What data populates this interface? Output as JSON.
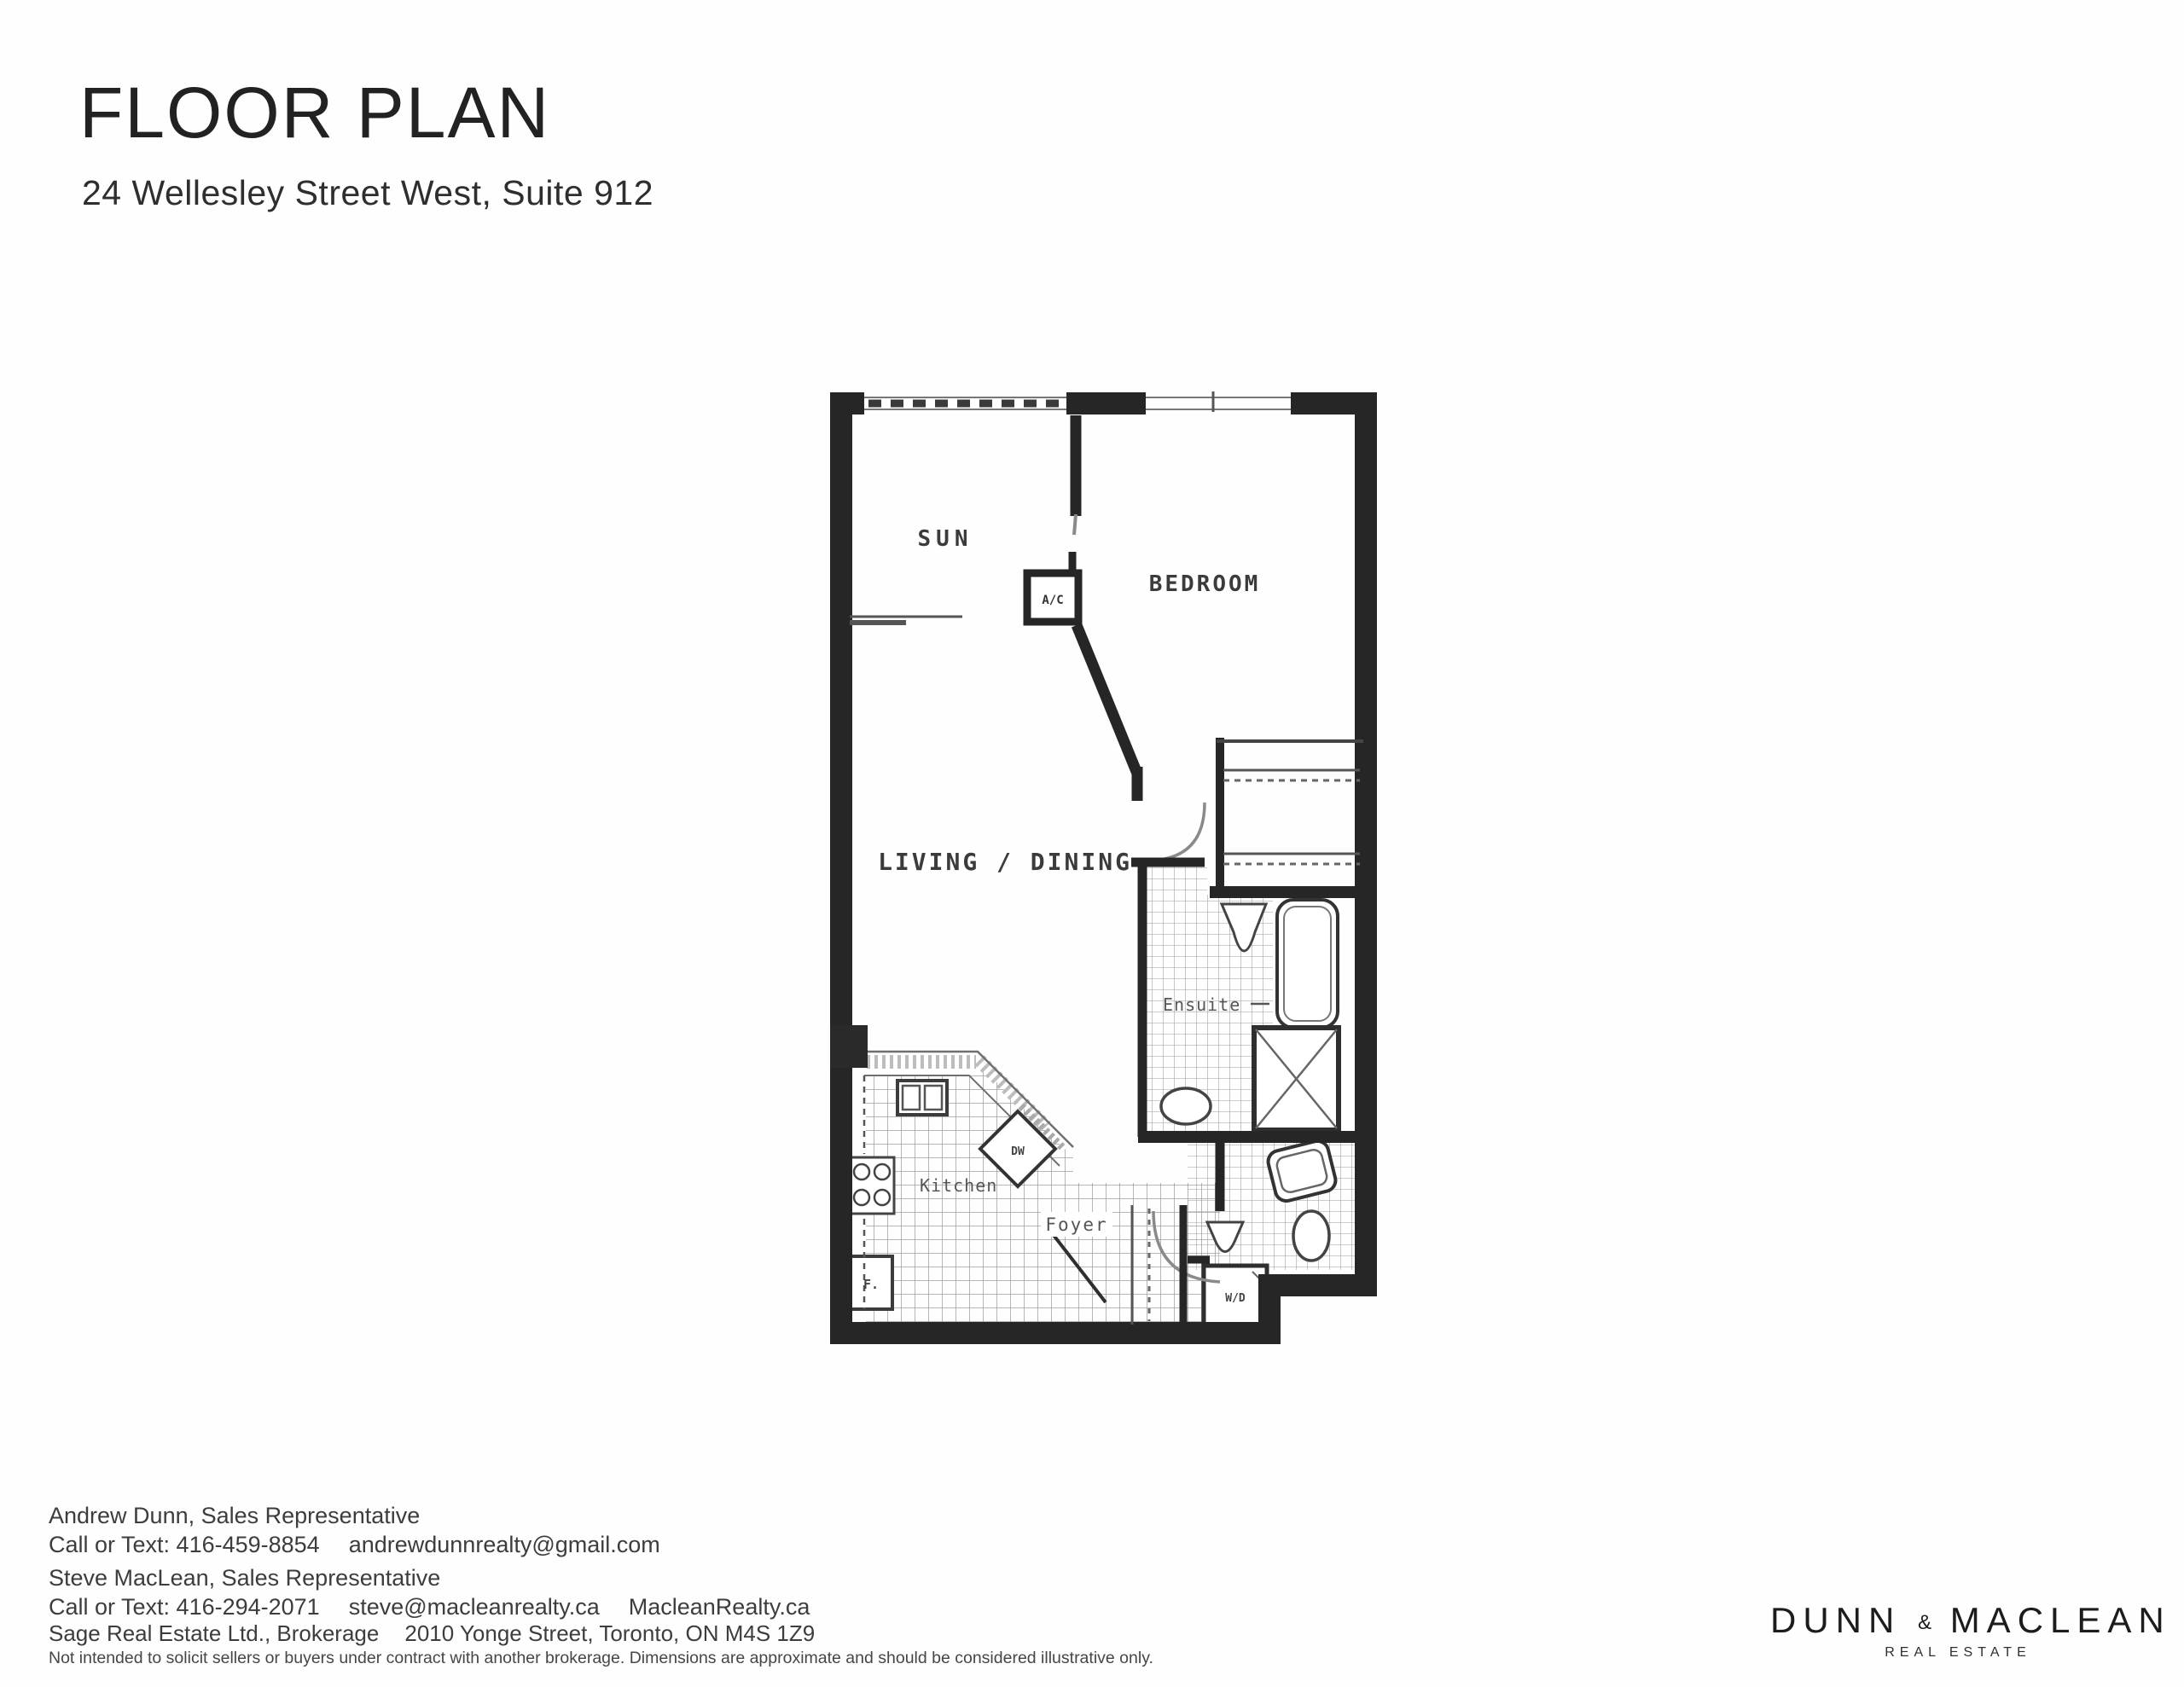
{
  "header": {
    "title": "FLOOR PLAN",
    "subtitle": "24 Wellesley Street West, Suite 912"
  },
  "plan": {
    "labels": {
      "sun": "SUN",
      "ac": "A/C",
      "bedroom": "BEDROOM",
      "living_dining": "LIVING / DINING",
      "ensuite": "Ensuite",
      "dw": "DW",
      "kitchen": "Kitchen",
      "foyer": "Foyer",
      "fridge": "F.",
      "washer_dryer": "W/D"
    }
  },
  "agents": [
    {
      "name": "Andrew Dunn, Sales Representative",
      "phone": "Call or Text: 416-459-8854",
      "email": "andrewdunnrealty@gmail.com",
      "website": ""
    },
    {
      "name": "Steve MacLean, Sales Representative",
      "phone": "Call or Text: 416-294-2071",
      "email": "steve@macleanrealty.ca",
      "website": "MacleanRealty.ca"
    }
  ],
  "brokerage": {
    "name": "Sage Real Estate Ltd., Brokerage",
    "address": "2010 Yonge Street, Toronto, ON M4S 1Z9",
    "disclaimer": "Not intended to solicit sellers or buyers under contract with another brokerage. Dimensions are approximate and should be considered illustrative only."
  },
  "logo": {
    "left": "DUNN",
    "amp": "&",
    "right": "MACLEAN",
    "tagline": "REAL ESTATE"
  }
}
